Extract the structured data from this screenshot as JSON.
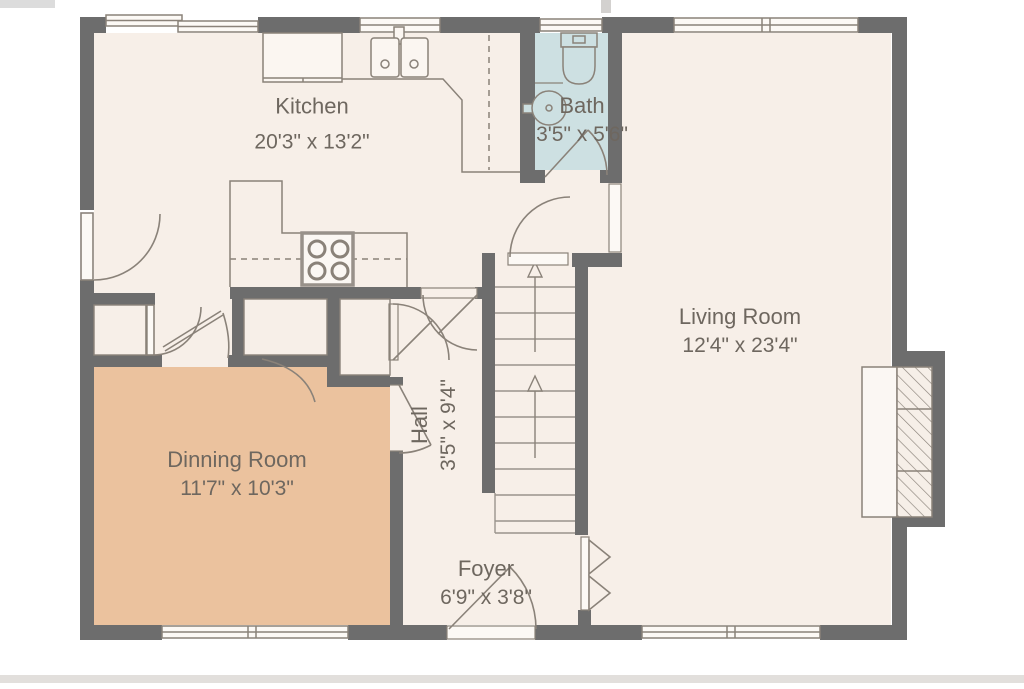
{
  "plan": {
    "title": "First floor plan",
    "rooms": [
      {
        "id": "kitchen",
        "name": "Kitchen",
        "dims": "20'3\" x 13'2\""
      },
      {
        "id": "bath",
        "name": "Bath",
        "dims": "3'5\" x 5'6\""
      },
      {
        "id": "living",
        "name": "Living Room",
        "dims": "12'4\" x 23'4\""
      },
      {
        "id": "dining",
        "name": "Dinning Room",
        "dims": "11'7\" x 10'3\""
      },
      {
        "id": "hall",
        "name": "Hall",
        "dims": "3'5\" x 9'4\""
      },
      {
        "id": "foyer",
        "name": "Foyer",
        "dims": "6'9\" x 3'8\""
      }
    ],
    "colors": {
      "wall": "#6d6d6d",
      "floor": "#f7efe8",
      "dining_floor": "#ebc29e",
      "bath_floor": "#cde0e2",
      "fixture_line": "#8a8279",
      "text": "#6e675f",
      "window_fill": "#fcf9f5"
    }
  }
}
